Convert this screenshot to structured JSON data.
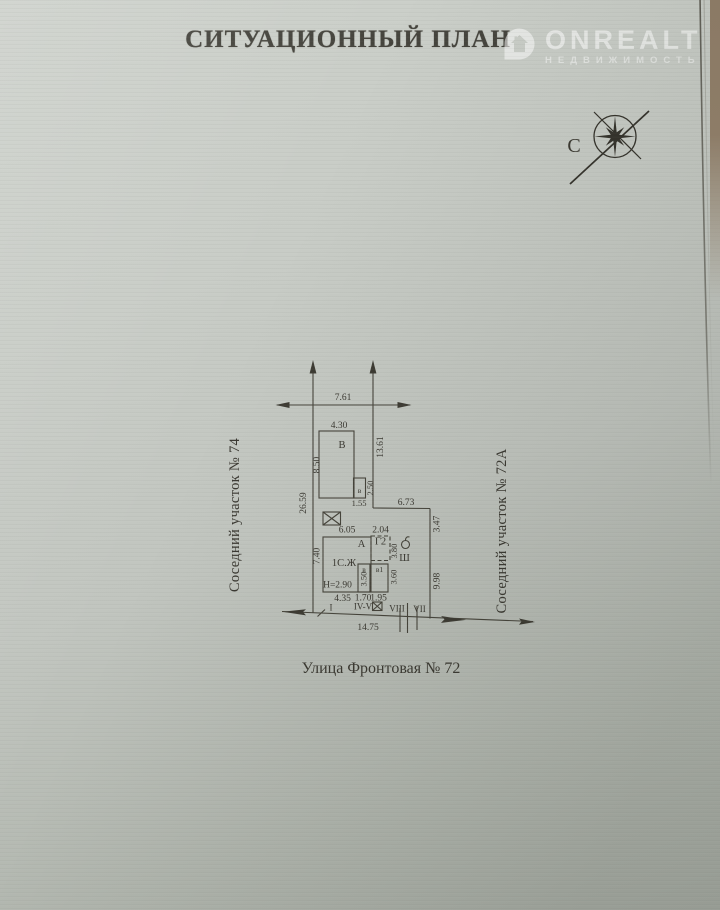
{
  "document": {
    "title": "СИТУАЦИОННЫЙ ПЛАН"
  },
  "watermark": {
    "brand": "ONREALT",
    "tagline": "НЕДВИЖИМОСТЬ"
  },
  "compass": {
    "north": "С"
  },
  "plan": {
    "labels": {
      "left_neighbor": "Соседний участок № 74",
      "right_neighbor": "Соседний участок № 72А",
      "street": "Улица Фронтовая № 72"
    },
    "buildings": {
      "b_big": "В",
      "b_annex": "в",
      "a_house": "А",
      "house_type": "1С.Ж",
      "house_height": "Н=2.90",
      "g2": "Г2",
      "v": "в",
      "v1": "в1",
      "well": "Ш"
    },
    "dims": {
      "front_top": "7.61",
      "b_width": "4.30",
      "b_depth": "8.50",
      "b_annex_w": "1.55",
      "b_annex_d": "2.50",
      "left_side": "26.59",
      "right_side_upper": "13.61",
      "north_jog": "6.73",
      "right_seg_1": "3.47",
      "right_seg_2": "9.98",
      "a_width": "6.05",
      "g2_width": "2.04",
      "g2_depth": "3.80",
      "a_depth": "7.40",
      "v_depth": "3.50",
      "v1_depth": "3.60",
      "bottom_a": "4.35",
      "bottom_v": "1.70",
      "bottom_v1": "1.95",
      "street_front": "14.75"
    },
    "marks": {
      "m1": "I",
      "m2": "IV-V",
      "m3": "VIII",
      "m4": "VII"
    }
  }
}
